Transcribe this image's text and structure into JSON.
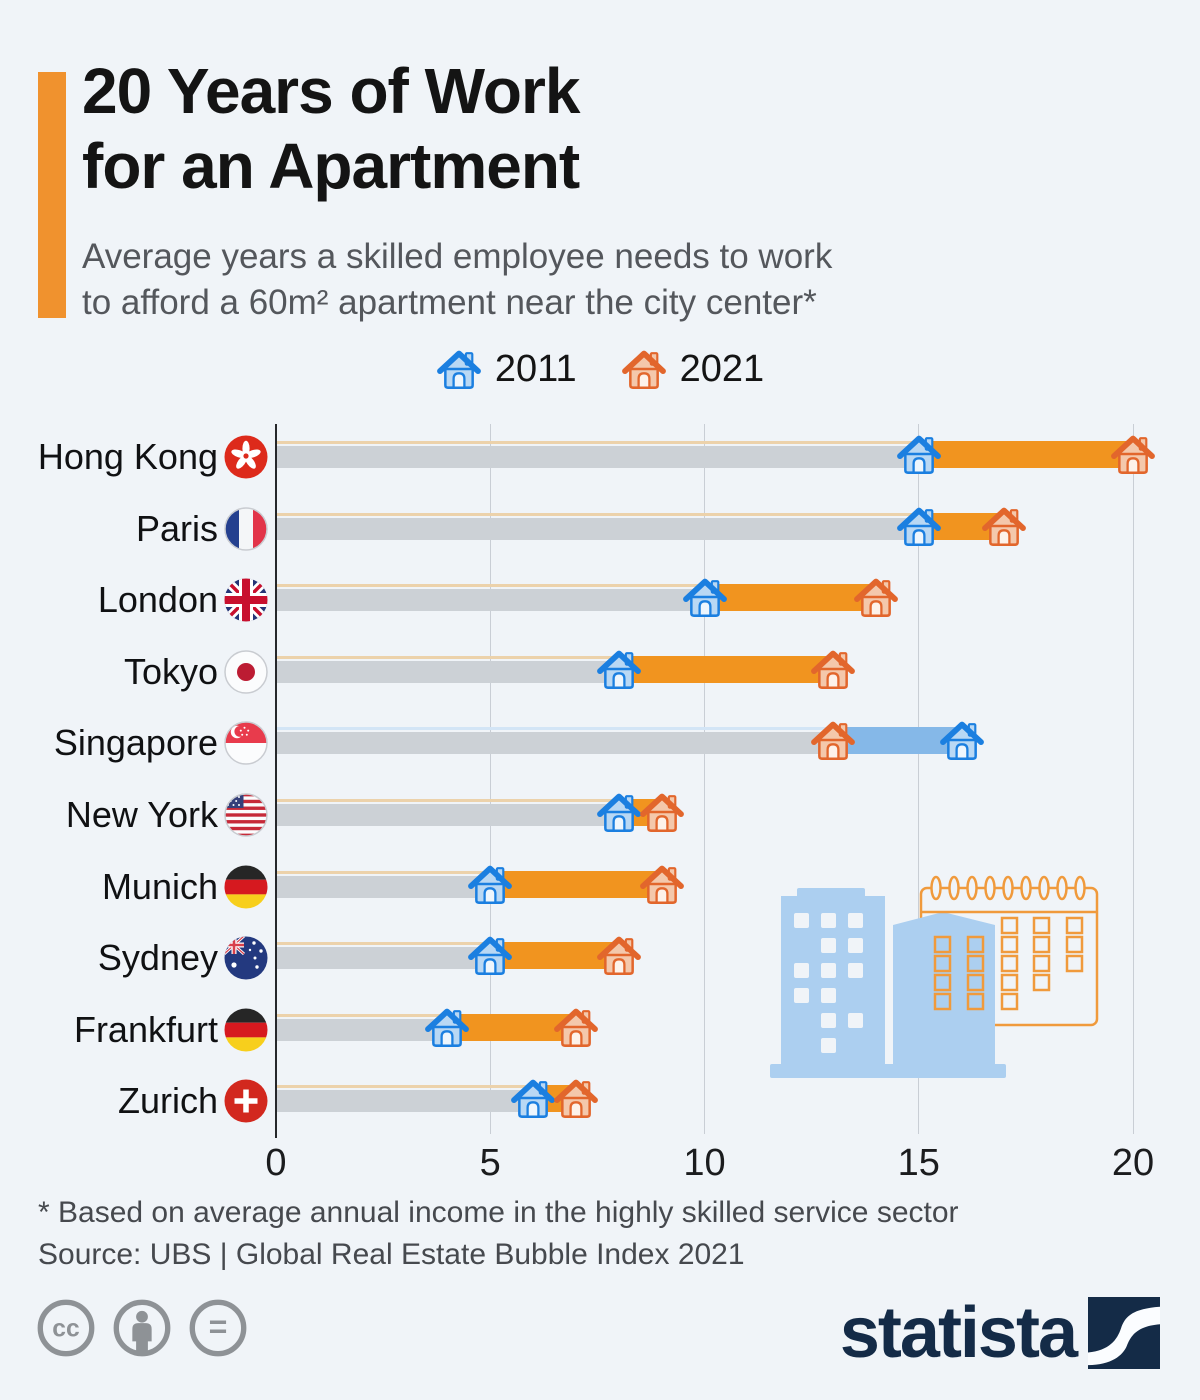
{
  "header": {
    "title_line1": "20 Years of Work",
    "title_line2": "for an Apartment",
    "subtitle_line1": "Average years a skilled employee needs to work",
    "subtitle_line2": "to afford a 60m² apartment near the city center*"
  },
  "legend": {
    "items": [
      {
        "label": "2011",
        "series": "2011",
        "color_key": "blue"
      },
      {
        "label": "2021",
        "series": "2021",
        "color_key": "orange"
      }
    ]
  },
  "chart_data": {
    "type": "bar",
    "subtype": "dumbbell-range",
    "title": "20 Years of Work for an Apartment",
    "subtitle": "Average years a skilled employee needs to work to afford a 60m² apartment near the city center*",
    "unit": "years",
    "xlabel": "",
    "ylabel": "",
    "x_axis": {
      "ticks": [
        0,
        5,
        10,
        15,
        20
      ],
      "range": [
        0,
        20
      ],
      "grid": true
    },
    "legend_entries": [
      "2011",
      "2021"
    ],
    "categories": [
      "Hong Kong",
      "Paris",
      "London",
      "Tokyo",
      "Singapore",
      "New York",
      "Munich",
      "Sydney",
      "Frankfurt",
      "Zurich"
    ],
    "series": [
      {
        "name": "2011",
        "values": [
          15,
          15,
          10,
          8,
          16,
          8,
          5,
          5,
          4,
          6
        ]
      },
      {
        "name": "2021",
        "values": [
          20,
          17,
          14,
          13,
          13,
          9,
          9,
          8,
          7,
          7
        ]
      }
    ],
    "rows": [
      {
        "city": "Hong Kong",
        "flag": "hk",
        "y2011": 15,
        "y2021": 20
      },
      {
        "city": "Paris",
        "flag": "fr",
        "y2011": 15,
        "y2021": 17
      },
      {
        "city": "London",
        "flag": "gb",
        "y2011": 10,
        "y2021": 14
      },
      {
        "city": "Tokyo",
        "flag": "jp",
        "y2011": 8,
        "y2021": 13
      },
      {
        "city": "Singapore",
        "flag": "sg",
        "y2011": 16,
        "y2021": 13
      },
      {
        "city": "New York",
        "flag": "us",
        "y2011": 8,
        "y2021": 9
      },
      {
        "city": "Munich",
        "flag": "de",
        "y2011": 5,
        "y2021": 9
      },
      {
        "city": "Sydney",
        "flag": "au",
        "y2011": 5,
        "y2021": 8
      },
      {
        "city": "Frankfurt",
        "flag": "de",
        "y2011": 4,
        "y2021": 7
      },
      {
        "city": "Zurich",
        "flag": "ch",
        "y2011": 6,
        "y2021": 7
      }
    ]
  },
  "footer": {
    "footnote": "* Based on average annual income in the highly skilled service sector",
    "source": "Source: UBS | Global Real Estate Bubble Index 2021",
    "license_icons": [
      "cc",
      "by",
      "nd"
    ],
    "brand": "statista"
  },
  "colors": {
    "background": "#f0f4f8",
    "accent_orange": "#f0922e",
    "bar_gray": "#ccd1d6",
    "bar_orange": "#f1941f",
    "bar_blue": "#85b8e8",
    "bar_orange_topline": "#ecd2ab",
    "bar_blue_topline": "#d3e5f6",
    "house_2011_stroke": "#1b7fe0",
    "house_2011_fill": "#b9d8f4",
    "house_2021_stroke": "#e2662c",
    "house_2021_fill": "#f4c8ab",
    "grid": "#c9ced5",
    "axis": "#26282b",
    "statista_navy": "#142b47",
    "decoration_blue": "#accff0",
    "decoration_orange": "#f09a3c",
    "license_gray": "#8e9296"
  }
}
